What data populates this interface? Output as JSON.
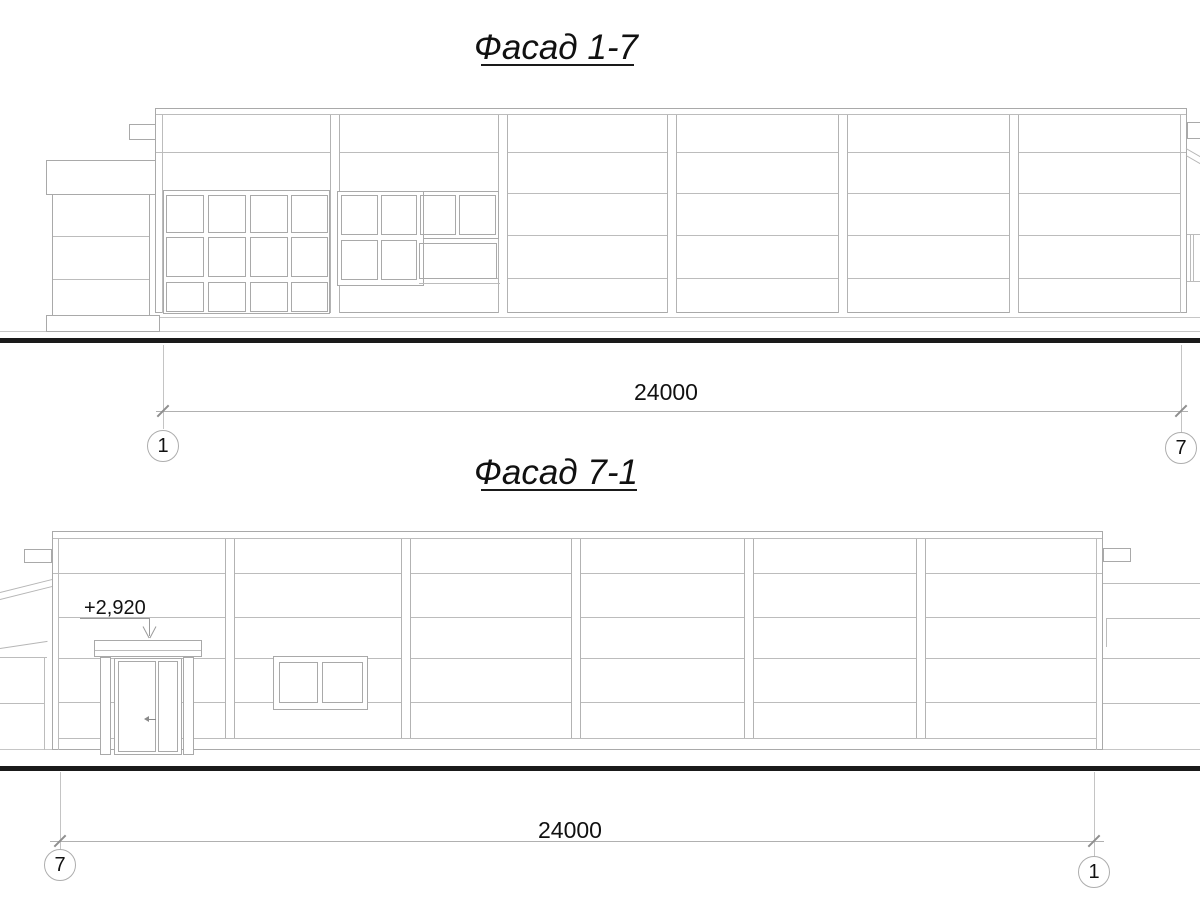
{
  "drawing": {
    "facade1": {
      "title": "Фасад 1-7",
      "dimension": "24000",
      "axis_left": "1",
      "axis_right": "7"
    },
    "facade2": {
      "title": "Фасад 7-1",
      "dimension": "24000",
      "axis_left": "7",
      "axis_right": "1",
      "elevation_mark": "+2,920"
    },
    "colors": {
      "line": "#bcbcbc",
      "outline": "#a9a9a9",
      "ground": "#1a1a1a",
      "text": "#111111"
    }
  }
}
